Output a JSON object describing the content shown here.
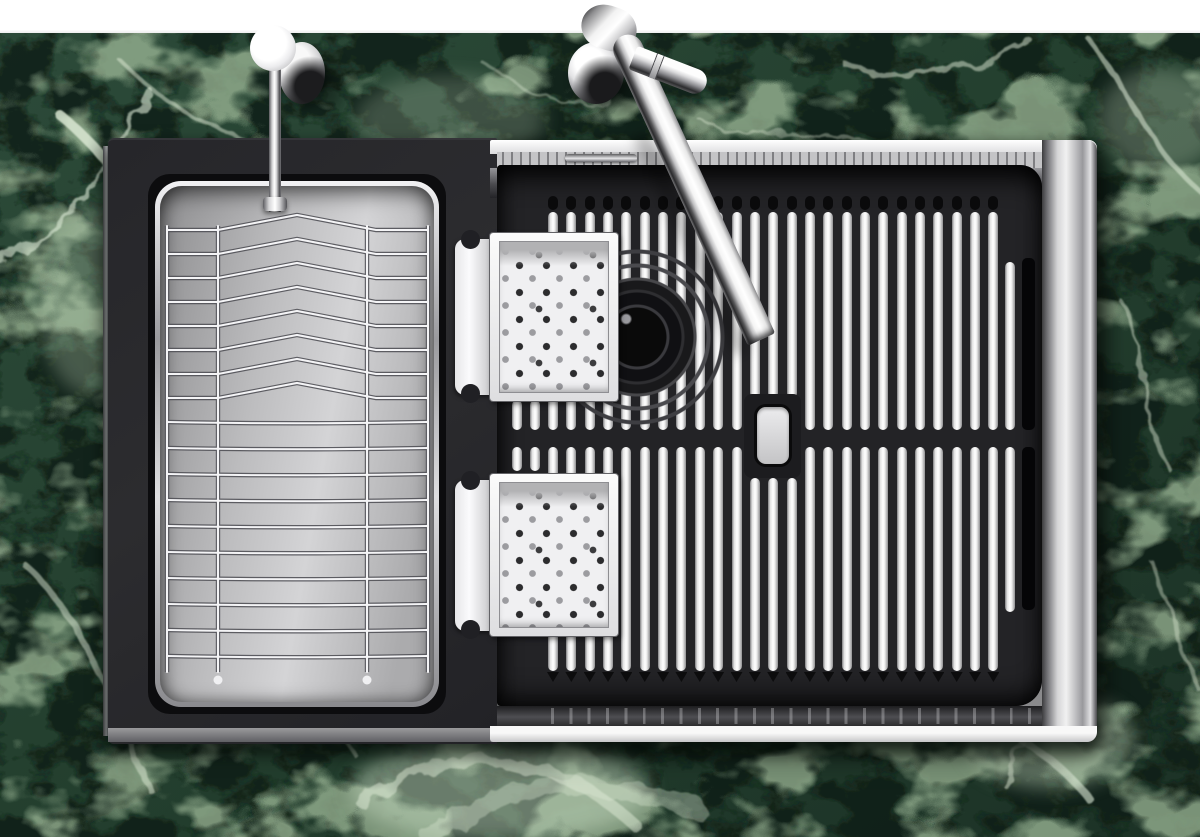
{
  "meta": {
    "description": "Top-down product render of a black workstation kitchen sink set into a green marble countertop: stainless wire dish rack on the left, black slatted grid cover with drain and sliding perforated colander trays on the right, wall-mounted chrome faucet and chrome side valve at top"
  },
  "palette": {
    "wall": "#ffffff",
    "marble_base": "#31503f",
    "marble_shadow": "#14241b",
    "marble_vein": "#e2eedb",
    "black_module": "#26262a",
    "grate_background": "#232326",
    "slat_face": "#ffffff",
    "slat_edge": "#7e7e80",
    "steel_bright": "#f5f5f5",
    "steel_mid": "#c4c4c6",
    "steel_dark": "#3c3c3e",
    "chrome_highlight": "#ffffff",
    "chrome_shadow": "#2a2a2c",
    "tray_face": "#f0f0f2",
    "perforation_dark": "#2c2c2e",
    "perforation_light": "#9c9ca0"
  },
  "objects": {
    "grate": {
      "columns": 25,
      "pitch": 18.35,
      "first_x": 548,
      "slat_width": 10,
      "top_run": [
        212,
        430
      ],
      "bottom_run": [
        447,
        671
      ],
      "hole_columns": [
        11,
        12,
        13
      ],
      "hole_top_end": 398,
      "hole_bottom_start": 478,
      "seam_stubs": [
        511.5,
        529.5
      ],
      "short_column_x": 1005,
      "slot_column_x": 1022,
      "notch_y": 196,
      "wedge_y": 507
    },
    "basket": {
      "width": 275,
      "height": 517,
      "chevron_rows": 8,
      "chevron_y_start": 44,
      "chevron_step": 24,
      "apex_rise": 15,
      "apex_x": 137,
      "straight_rows": 10,
      "straight_y_start": 236,
      "straight_step": 26,
      "verticals": [
        7,
        58,
        207,
        268
      ],
      "feet": [
        58,
        207
      ]
    },
    "drain": {
      "cx": 637,
      "cy": 337
    },
    "colanders": [
      {
        "body": {
          "x": 490,
          "y": 233,
          "w": 128,
          "h": 168
        },
        "handle": {
          "x": 455,
          "y": 239,
          "h": 156
        },
        "notches_y": [
          230,
          384
        ]
      },
      {
        "body": {
          "x": 490,
          "y": 474,
          "w": 128,
          "h": 162
        },
        "handle": {
          "x": 455,
          "y": 480,
          "h": 151
        },
        "notches_y": [
          471,
          620
        ]
      }
    ]
  }
}
